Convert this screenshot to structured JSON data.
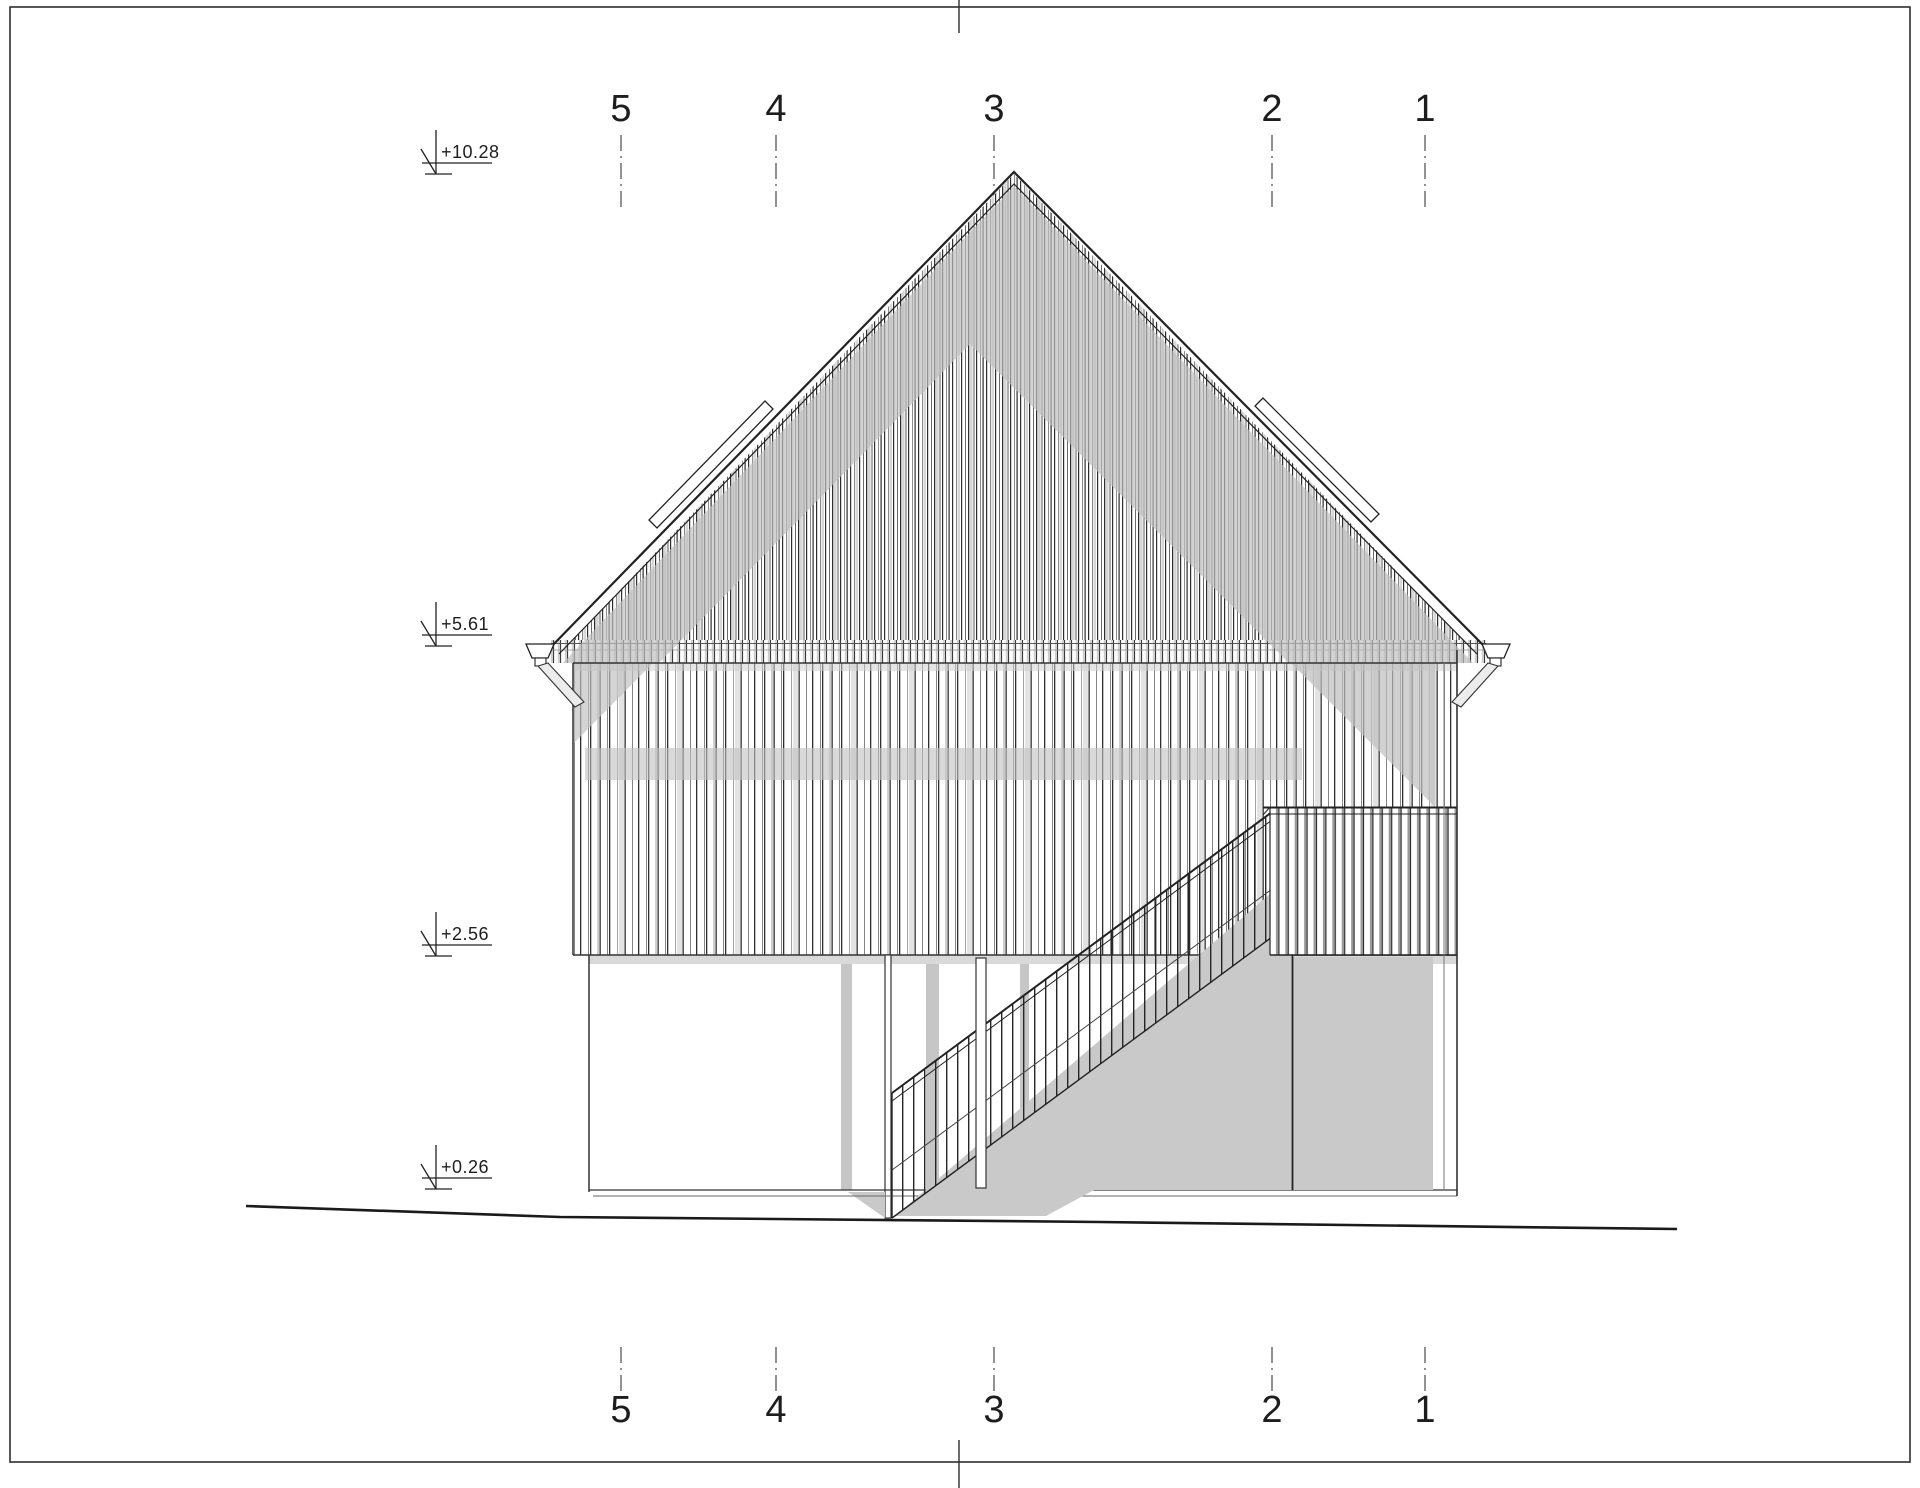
{
  "drawing": {
    "kind": "building gable-end elevation",
    "grid_axes": {
      "labels": [
        "5",
        "4",
        "3",
        "2",
        "1"
      ]
    },
    "levels": [
      {
        "label": "+10.28"
      },
      {
        "label": "+5.61"
      },
      {
        "label": "+2.56"
      },
      {
        "label": "+0.26"
      }
    ],
    "colors": {
      "line": "#2e2e2e",
      "shadow": "#c7c7c7",
      "post": "#c6c6c6",
      "ground": "#1a1a1a",
      "background": "#ffffff"
    }
  }
}
